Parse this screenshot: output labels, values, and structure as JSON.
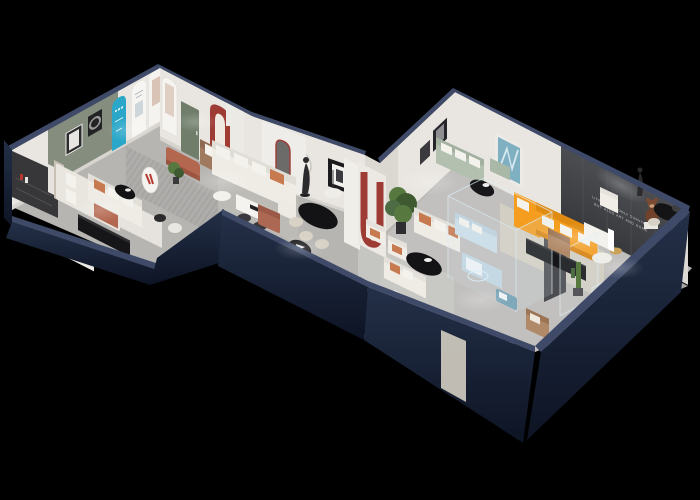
{
  "scene": {
    "type": "3d-isometric-showroom-floorplan-render",
    "slogan_line1": "LIFE IS NOT ONLY SURVIVAL",
    "slogan_line2": "BUT ALSO ART AND HOME"
  },
  "colors": {
    "background": "#000000",
    "navy_wall_top": "#3e4a68",
    "navy_wall_face": "#243048",
    "navy_wall_face_dark": "#0d1424",
    "wall_white": "#e9e6e1",
    "wall_green": "#858d7e",
    "door_green": "#6f7d6a",
    "dark_accent_wall": "#4b4d51",
    "dark_accent_wall_deep": "#37393d",
    "teal_display": "#2aa7c8",
    "red_arch": "#9e3b35",
    "logo_red": "#b5372d",
    "floor_gray": "#b7b5b2",
    "floor_light": "#c4c2bf",
    "rug_beige": "#d8d2c4",
    "rug_sage": "#c9cbc6",
    "sofa_white": "#efece6",
    "cushion_terracotta": "#c7794f",
    "sofa_brown": "#a07a5e",
    "sofa_sage": "#b3c0b0",
    "sofa_orange": "#f59d1f",
    "sofa_orange_deep": "#e08c12",
    "sofa_blue": "#ccdde8",
    "ottoman_terracotta": "#b4674f",
    "ottoman_blue": "#7fa8bb",
    "armchair_tan": "#b08968",
    "bear_brown": "#7a4a32",
    "console_black": "#161618",
    "chair_cream": "#d8d2c6",
    "table_black": "#131315",
    "plant_green": "#57793f",
    "plant_green_dark": "#3f5a31",
    "glass_blue": "#cfe4ee",
    "doorway_light": "#c9c5bb",
    "bed_white": "#e9e6e0",
    "headboard_dark": "#37373a"
  },
  "rooms": [
    {
      "name": "display-gallery",
      "items": [
        "teal-arch-display",
        "white-arch-posters",
        "framed-art",
        "terracotta-ottoman",
        "brown-leather-sofa",
        "white-sofa",
        "black-coffee-table",
        "potted-plant",
        "oval-logo-sign"
      ]
    },
    {
      "name": "bedroom-display",
      "items": [
        "double-bed",
        "terracotta-throw",
        "dark-headboard-shelf",
        "black-media-console",
        "white-book-shelf",
        "side-tables"
      ]
    },
    {
      "name": "living-dining-display",
      "items": [
        "white-sectional-sofa",
        "white-dining-table",
        "black-round-dining-table",
        "cream-chairs",
        "pendant-dome-lamp",
        "mannequin-sculpture",
        "red-arch-niche",
        "red-u-pillar",
        "potted-tree",
        "white-armchairs",
        "black-oval-coffee-table",
        "ribbed-runner-rug",
        "black-disc-mat"
      ]
    },
    {
      "name": "main-showroom",
      "items": [
        "orange-sectional-sofa",
        "sage-green-sofa",
        "black-round-coffee-table",
        "black-media-console",
        "white-armchairs",
        "teddy-bear-figure",
        "glass-partition-room",
        "blue-display-sofa-set",
        "blue-ottoman",
        "glass-vitrines",
        "cactus",
        "tan-armchair",
        "black-dining-set",
        "mannequin-sculpture",
        "slogan-accent-wall",
        "white-sofa-pair",
        "nesting-tables",
        "doorway-mirror"
      ]
    }
  ]
}
